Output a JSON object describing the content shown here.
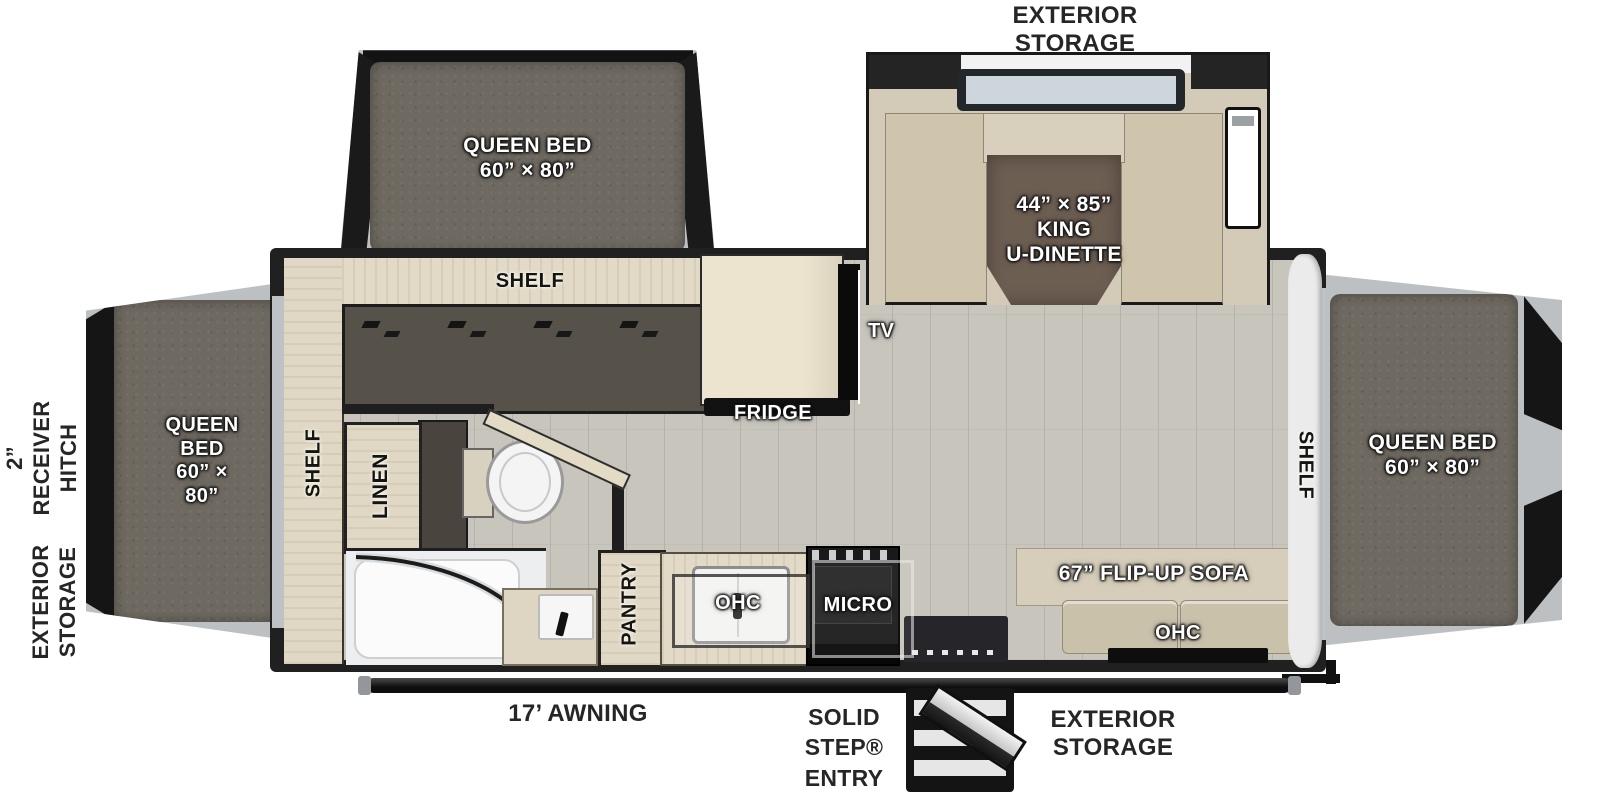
{
  "plan": {
    "exterior": {
      "storage_top": "EXTERIOR\nSTORAGE",
      "hitch": "2”\nRECEIVER\nHITCH",
      "storage_left": "EXTERIOR\nSTORAGE",
      "awning": "17’ AWNING",
      "entry": "SOLID\nSTEP®\nENTRY",
      "storage_bottom": "EXTERIOR\nSTORAGE"
    },
    "slides": {
      "front_bed": "QUEEN BED\n60” × 80”",
      "dinette": "44” × 85”\nKING\nU-DINETTE",
      "left_bed": "QUEEN\nBED\n60” × 80”",
      "right_bed": "QUEEN BED\n60” × 80”"
    },
    "interior": {
      "shelf_top": "SHELF",
      "shelf_left": "SHELF",
      "shelf_right": "SHELF",
      "tv": "TV",
      "fridge": "FRIDGE",
      "linen": "LINEN",
      "pantry": "PANTRY",
      "ohc_kitchen": "OHC",
      "micro": "MICRO",
      "sofa": "67” FLIP-UP SOFA",
      "ohc_sofa": "OHC"
    },
    "colors": {
      "wall": "#202020",
      "floor": "#c8c5bd",
      "wood": "#e2dac6",
      "mattress": "#6f6a61",
      "cushion": "#cfc5ad",
      "table": "#6d5e52",
      "frame_silver": "#bcc0c3",
      "label_dark": "#262626"
    }
  }
}
